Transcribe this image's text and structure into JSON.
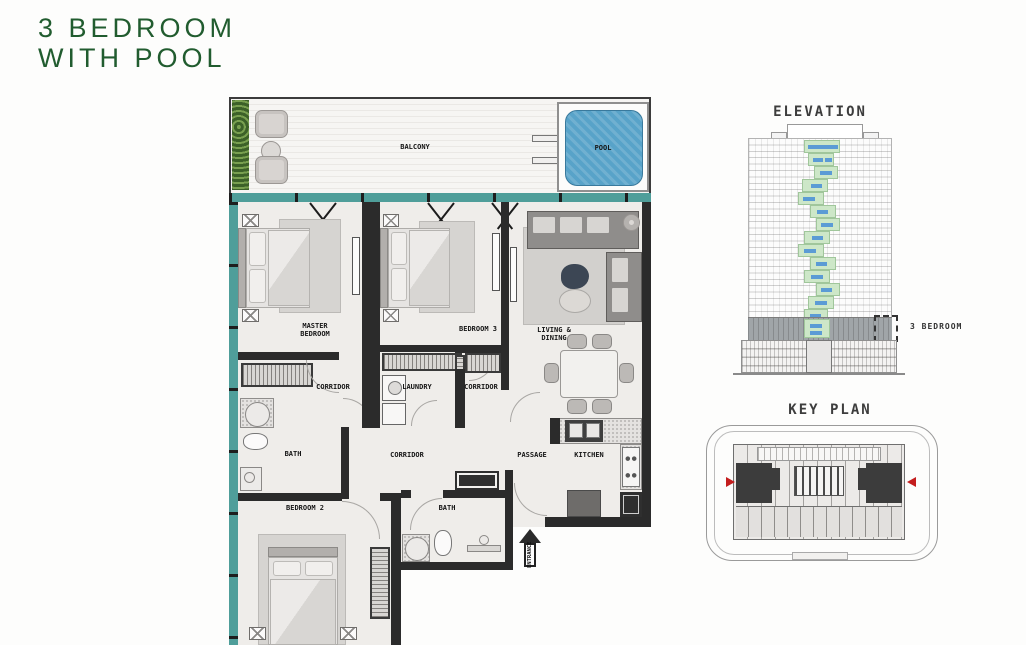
{
  "title": {
    "line1": "3 BEDROOM",
    "line2": "WITH POOL",
    "color": "#215c2f"
  },
  "floor_plan": {
    "labels": {
      "balcony": "BALCONY",
      "pool": "POOL",
      "master_line1": "MASTER",
      "master_line2": "BEDROOM",
      "bedroom3": "BEDROOM 3",
      "living_line1": "LIVING &",
      "living_line2": "DINING",
      "corridor_left": "CORRIDOR",
      "laundry": "LAUNDRY",
      "corridor_right": "CORRIDOR",
      "bath_master": "BATH",
      "corridor_main": "CORRIDOR",
      "passage": "PASSAGE",
      "kitchen": "KITCHEN",
      "bedroom2": "BEDROOM 2",
      "bath2": "BATH",
      "entrance": "ENTRANCE"
    },
    "colors": {
      "glass_teal": "#4f9e9a",
      "pool_water": "#58a3c9",
      "wall": "#2b2b2b",
      "deck": "#f5f4f2"
    }
  },
  "elevation": {
    "title": "ELEVATION",
    "callout_label": "3 BEDROOM",
    "highlight_green": "#cde7c8",
    "window_blue": "#5b9bd5"
  },
  "key_plan": {
    "title": "KEY PLAN",
    "marker_color": "#c41e1e"
  }
}
